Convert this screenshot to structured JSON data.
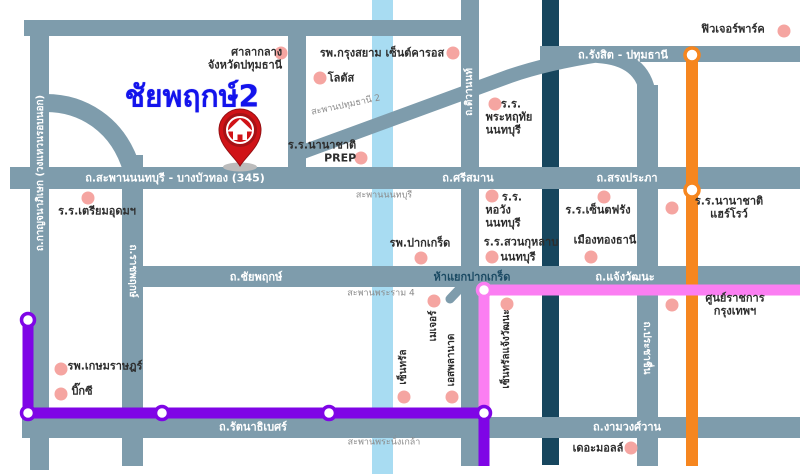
{
  "title": "ชัยพฤกษ์2",
  "roads": {
    "sapan_nonthaburi_bangbuathong_345": "ถ.สะพานนนทบุรี - บางบัวทอง (345)",
    "srisaman": "ถ.ศรีสมาน",
    "songprapha": "ถ.สรงประภา",
    "rangsit_pathumthani": "ถ.รังสิต - ปทุมธานี",
    "chaiyapruek": "ถ.ชัยพฤกษ์",
    "chaengwattana": "ถ.แจ้งวัฒนะ",
    "rattanathibet": "ถ.รัตนาธิเบศร์",
    "ngamwongwan": "ถ.งามวงศ์วาน",
    "kanchanaphisek": "ถ.กาญจนาภิเษก (วงแหวนรอบนอก)",
    "ratchaphruek": "ถ.ราชพฤกษ์",
    "tiwanon": "ถ.ติวานนท์",
    "prachachuen": "ถ.ประชาชื่น"
  },
  "junction": {
    "pakkret": "ห้าแยกปากเกร็ด"
  },
  "bridges": {
    "pathumthani2": "สะพานปทุมธานี 2",
    "nonthaburi": "สะพานนนทบุรี",
    "rama4": "สะพานพระราม 4",
    "phranangklao": "สะพานพระนั่งเกล้า"
  },
  "pois": {
    "city_hall": "ศาลากลาง\nจังหวัดปทุมธานี",
    "krungsiam_hospital": "รพ.กรุงสยาม เซ็นต์คารอส",
    "lotus": "โลตัส",
    "future_park": "ฟิวเจอร์พาร์ค",
    "prep_school": "ร.ร.นานาชาติ\nPREP",
    "phraharuthai_line1": "ร.ร.",
    "phraharuthai_rest": "พระหฤทัย\nนนทบุรี",
    "triamudom": "ร.ร.เตรียมอุดมฯ",
    "horwang_line1": "ร.ร.",
    "horwang_rest": "หอวัง\nนนทบุรี",
    "stfrang": "ร.ร.เซ็นตฟรัง",
    "harrow": "ร.ร.นานาชาติแฮร์โรว์",
    "muangthong": "เมืองทองธานี",
    "suankularb_line1": "ร.ร.สวนกุหลาบ",
    "suankularb_line2": "นนทบุรี",
    "pakkret_hospital": "รพ.ปากเกร็ด",
    "kasemrad_hospital": "รพ.เกษมราษฎร์",
    "bigc": "บิ๊กซี",
    "the_mall": "เดอะมอลล์",
    "gov_center": "ศูนย์ราชการกรุงเทพฯ",
    "central": "เซ็นทรัล",
    "major": "เมเจอร์",
    "esplanade": "เอสพลานาด",
    "central_chaengwattana": "เซ็นทรัลแจ้งวัฒนะ"
  },
  "colors": {
    "road": "#7E9CAC",
    "river": "#A8DCF2",
    "expressway": "#17465E",
    "orange_line": "#F6861F",
    "purple_line": "#7F05E6",
    "pink_line": "#FB7EF2",
    "poi_dot": "#F5A5A1",
    "pin_red": "#D01317",
    "title_blue": "#1313EC"
  }
}
